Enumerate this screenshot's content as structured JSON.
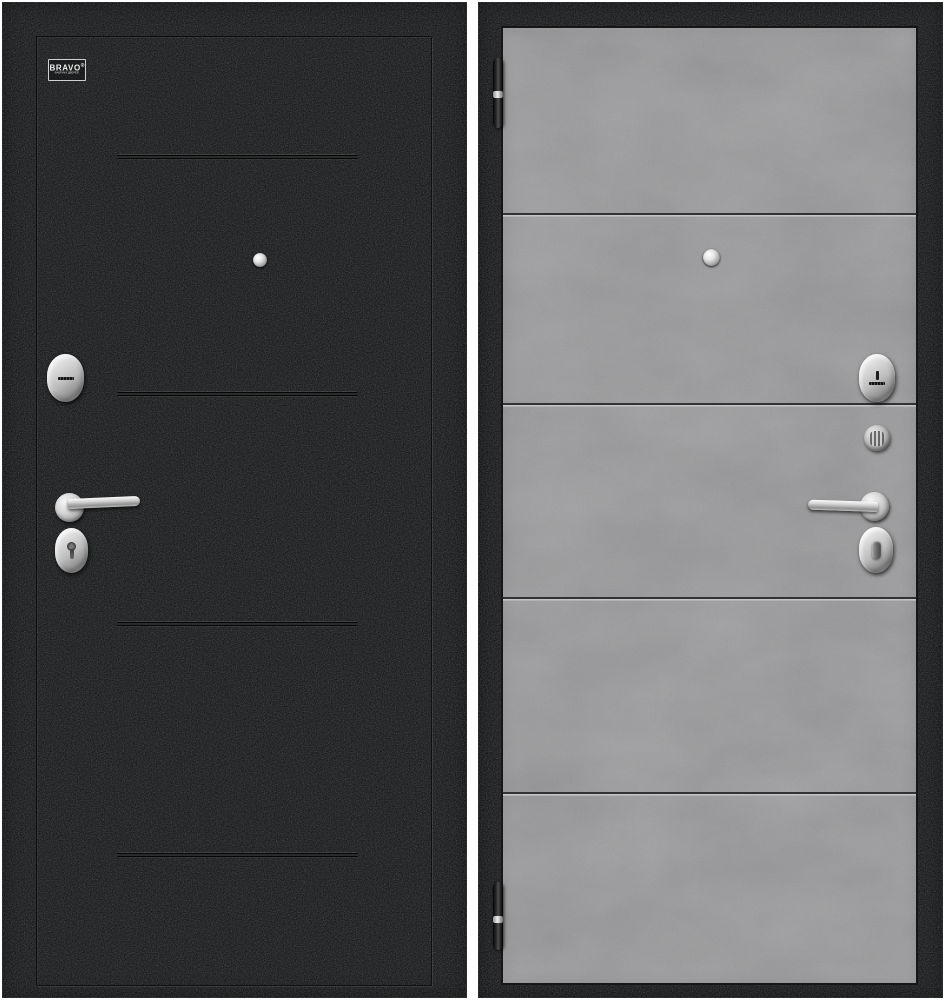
{
  "colors": {
    "canvas-bg": "#ffffff",
    "door-black": "#1b1d1e",
    "panel-gray": "#7d7d7f",
    "groove-dark": "#323234",
    "groove-light": "#c4c4c6",
    "chrome-light": "#f2f2f2",
    "chrome-mid": "#bcbcbc",
    "chrome-dark": "#8a8a8a"
  },
  "left_door": {
    "description": "black textured exterior door panel",
    "logo": {
      "brand": "BRAVO",
      "registered": "®",
      "tagline": "ФАБРИКА ДВЕРЕЙ"
    },
    "groove_count": 4,
    "hardware": [
      "peephole",
      "cylinder-escutcheon",
      "lever-handle",
      "keyhole-escutcheon"
    ]
  },
  "right_door": {
    "description": "gray concrete-finish interior door panel",
    "groove_count": 4,
    "hinge_count": 2,
    "hardware": [
      "peephole",
      "cylinder-escutcheon",
      "thumbturn-knob",
      "lever-handle",
      "thumbturn-escutcheon"
    ]
  }
}
